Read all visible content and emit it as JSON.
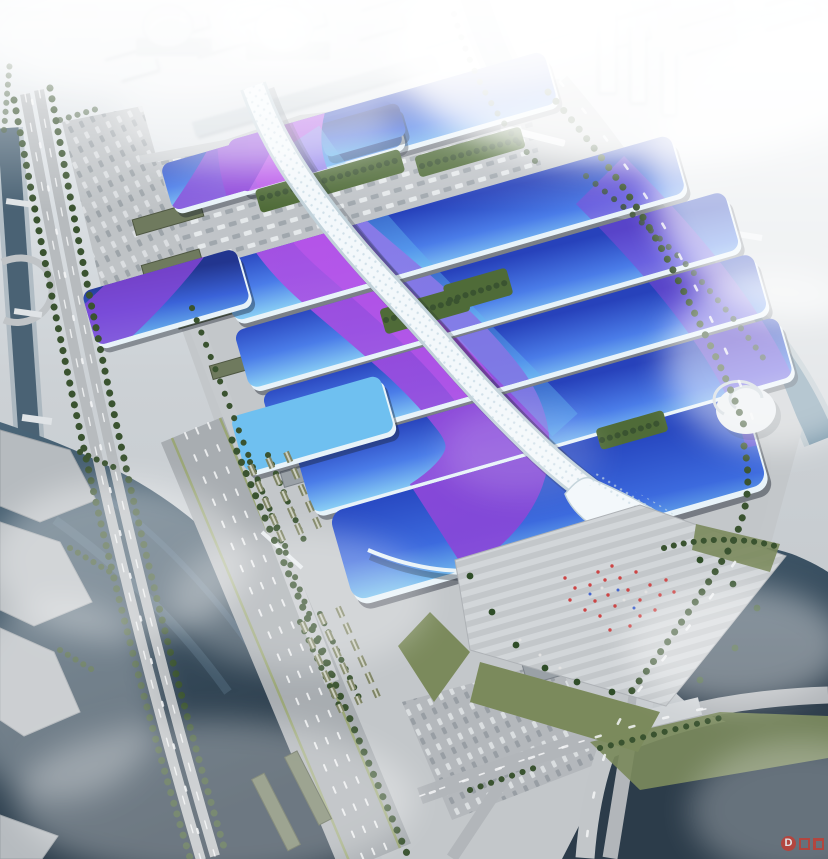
{
  "watermark": {
    "logo_char": "D"
  },
  "colors": {
    "sky_top": "#eef2f5",
    "ground": "#c6cacd",
    "city": "#e3e9ed",
    "city_shadow": "#c9d2d8",
    "water_river": "#6d8ea2",
    "water_lake_top": "#4a6578",
    "water_lake_bottom": "#293947",
    "water_dark": "#2c3c4a",
    "road": "#a8adb1",
    "road_light": "#c6cacd",
    "plaza": "#c3c7ca",
    "hall_light": "#8ad0f5",
    "hall_mid": "#4a7ce8",
    "hall_deep": "#2742bb",
    "hall_darkest": "#22358f",
    "purple": "#a94ae0",
    "purple_bright": "#c257ec",
    "purple_deep": "#8a46d8",
    "ribbon": "#f3f8fb",
    "ribbon_shade": "#c2d2da",
    "green_dark": "#3a5330",
    "green_lawn": "#7b8a5c",
    "green_court": "#4f6b38",
    "crowd_red": "#cc4444",
    "watermark_red": "#c63b30",
    "shadow": "#18202c"
  }
}
